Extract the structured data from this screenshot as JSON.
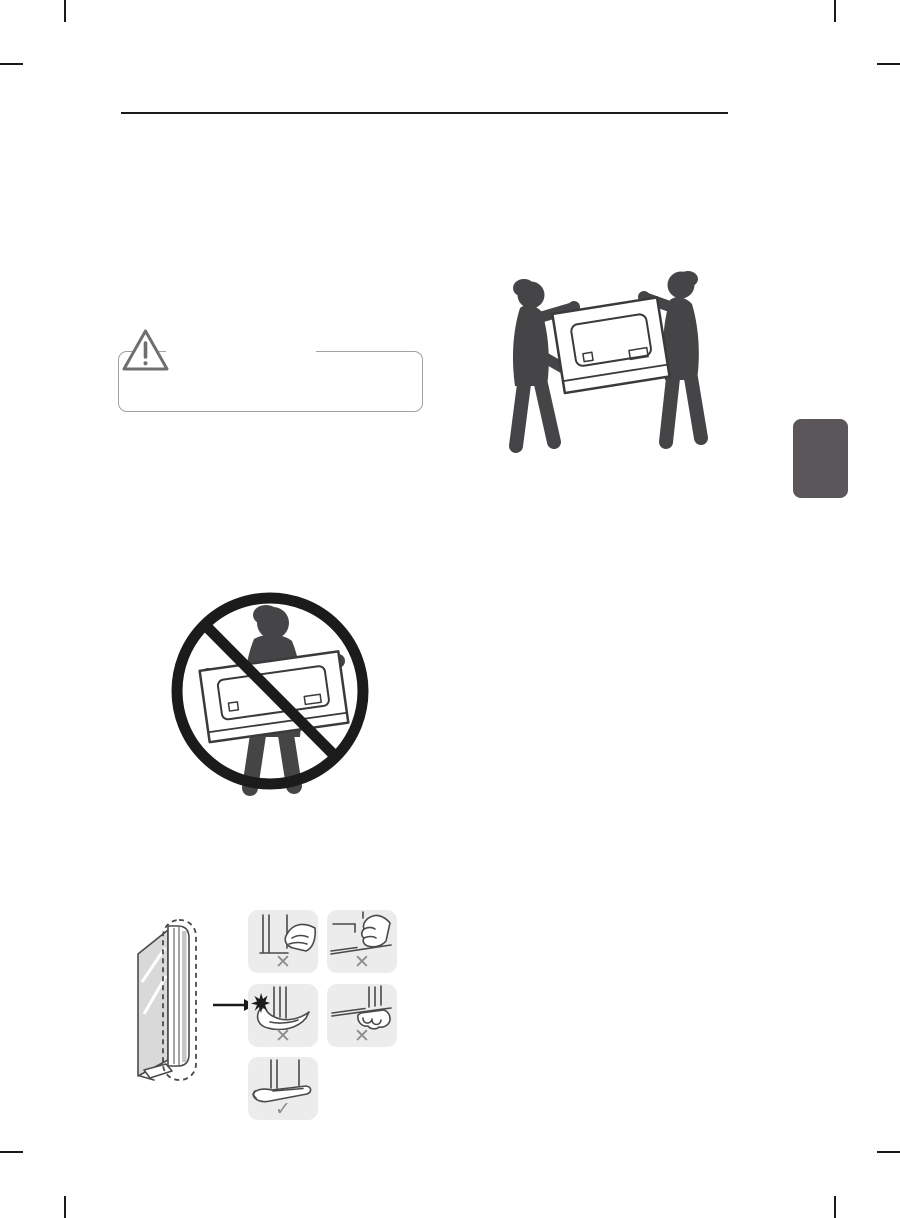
{
  "page": {
    "kind": "manual-illustration-page"
  },
  "colors": {
    "page_bg": "#ffffff",
    "rule": "#1a1a1a",
    "caution_border": "#a0a0a0",
    "warning_outline": "#6f6f6f",
    "silhouette": "#454547",
    "line": "#4a4a4c",
    "tv_outline": "#3a3a3c",
    "panel_bg": "#ececec",
    "mark_gray": "#8d8d8d",
    "tab": "#5b5659",
    "prohibition": "#1b1b1b",
    "screen_gray": "#d9d9d9",
    "strip_gray": "#c6c6c6"
  },
  "caution_note": {
    "icon": "warning-triangle-icon"
  },
  "illustrations": [
    {
      "name": "two-people-carrying-tv-illustration"
    },
    {
      "name": "do-not-carry-alone-prohibition-illustration"
    },
    {
      "name": "tv-side-view-with-dashed-highlight"
    },
    {
      "name": "arrow-right-icon"
    }
  ],
  "grip_panels": [
    {
      "name": "grip-screen-surface",
      "mark": "✕"
    },
    {
      "name": "grip-front-edge-fingers",
      "mark": "✕"
    },
    {
      "name": "press-corner-impact",
      "mark": "✕"
    },
    {
      "name": "grip-bottom-edge-fingers",
      "mark": "✕"
    },
    {
      "name": "support-bottom-flat-palm",
      "mark": "✓"
    }
  ]
}
